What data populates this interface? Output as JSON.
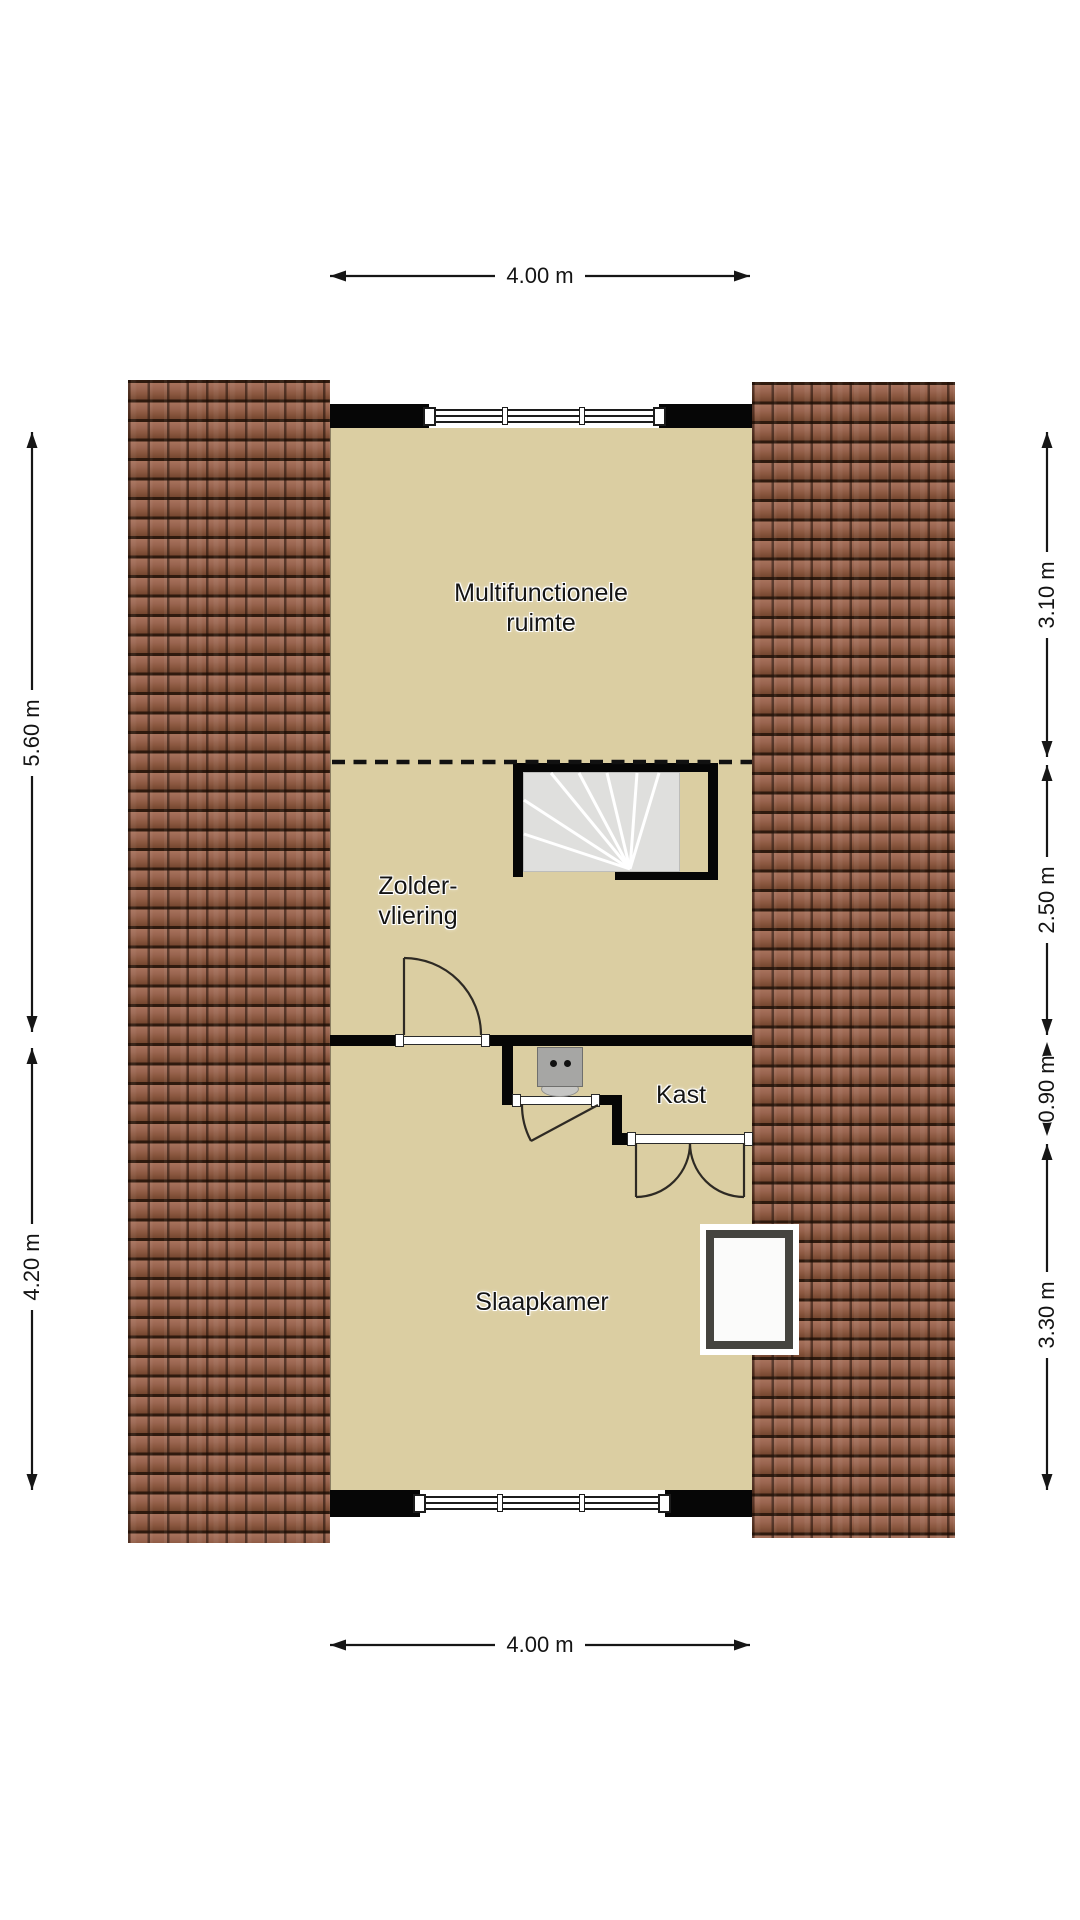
{
  "rooms": {
    "multifunctionele": {
      "line1": "Multifunctionele",
      "line2": "ruimte"
    },
    "zolder": {
      "line1": "Zolder-",
      "line2": "vliering"
    },
    "kast": {
      "label": "Kast"
    },
    "slaapkamer": {
      "label": "Slaapkamer"
    }
  },
  "dims": {
    "top": "4.00 m",
    "bottom": "4.00 m",
    "left_upper": "5.60 m",
    "left_lower": "4.20 m",
    "right_top": "3.10 m",
    "right_mid": "2.50 m",
    "right_small": "0.90 m",
    "right_bottom": "3.30 m"
  },
  "colors": {
    "floor": "#dbcea2",
    "roof_tile": "#98644f",
    "roof_joint": "#2f1a0e",
    "wall": "#060606",
    "stairs": "#dfdfdd",
    "door_line": "#2e2a24",
    "roof_window_frame": "#45443f",
    "text": "#141414"
  }
}
